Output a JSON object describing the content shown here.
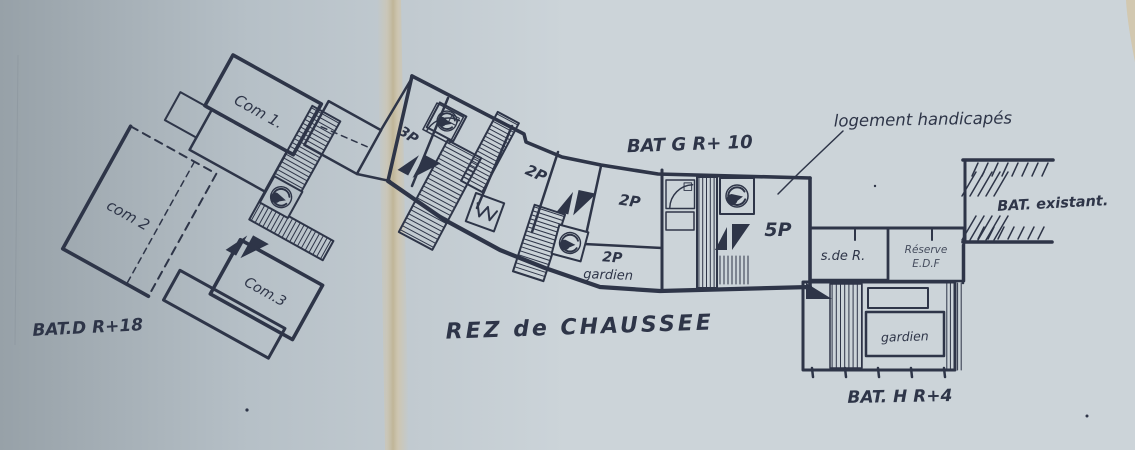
{
  "colors": {
    "paper-left": "#97a1a8",
    "paper-mid": "#b6c0c7",
    "paper-right": "#ccd4d9",
    "fold": "#d2c5a8",
    "fold-deep": "#c0b28e",
    "ink": "#2e3548",
    "crease": "#87919a"
  },
  "labels": {
    "com1": "Com 1.",
    "com2": "com 2",
    "com3": "Com.3",
    "bat_d": "BAT.D R+18",
    "p3": "3P",
    "p2a": "2P",
    "p2b": "2P",
    "p2c": "2P",
    "gardien_g": "gardien",
    "p5": "5P",
    "bat_g": "BAT G R+ 10",
    "rez": "REZ de CHAUSSEE",
    "logement": "logement handicapés",
    "sdr": "s.de R.",
    "reserve_1": "Réserve",
    "reserve_2": "E.D.F",
    "gardien_h": "gardien",
    "bat_h": "BAT. H R+4",
    "existant": "BAT. existant."
  }
}
